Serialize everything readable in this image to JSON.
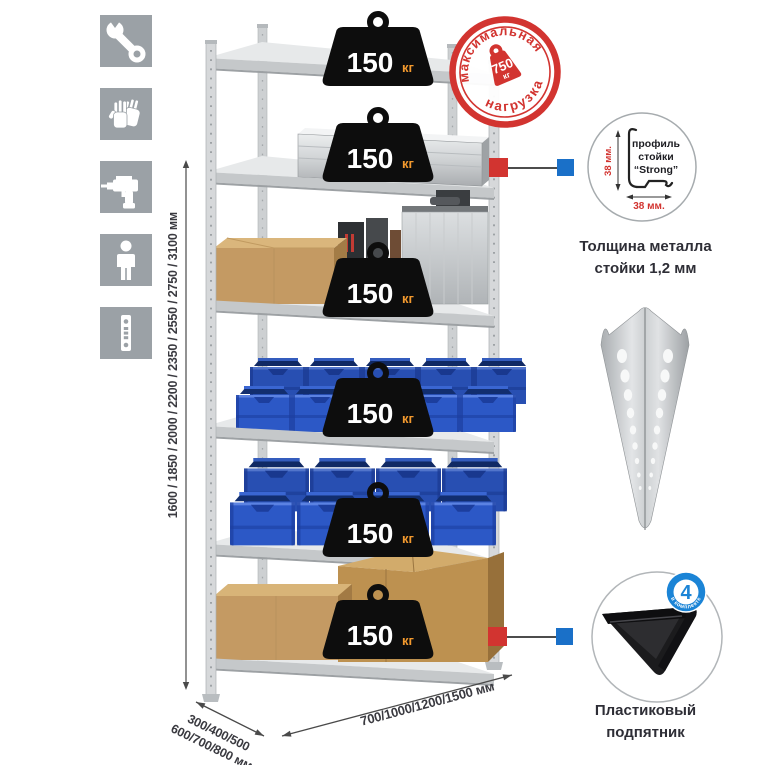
{
  "colors": {
    "accent-red": "#d23430",
    "accent-blue": "#1a70c8",
    "icon-gray": "#9ba1a6",
    "bin-blue": "#2c58c6",
    "unit-orange": "#f2992e",
    "text-dark": "#3a3a40",
    "cardboard": "#c49a63",
    "metal": "#d6d8da"
  },
  "left_icons": {
    "items": [
      {
        "name": "wrench"
      },
      {
        "name": "work-gloves"
      },
      {
        "name": "drill"
      },
      {
        "name": "person"
      },
      {
        "name": "perforated-post"
      }
    ]
  },
  "dimensions": {
    "height": "1600 / 1850 / 2000 / 2200 / 2350 / 2550 / 2750 / 3100 мм",
    "depth_line1": "300/400/500",
    "depth_line2": "600/700/800 мм",
    "width": "700/1000/1200/1500 мм"
  },
  "shelf": {
    "levels": [
      {
        "load": "150",
        "unit": "кг"
      },
      {
        "load": "150",
        "unit": "кг"
      },
      {
        "load": "150",
        "unit": "кг"
      },
      {
        "load": "150",
        "unit": "кг"
      },
      {
        "load": "150",
        "unit": "кг"
      },
      {
        "load": "150",
        "unit": "кг"
      }
    ]
  },
  "stamp": {
    "arc_top": "максимальная",
    "arc_bottom": "нагрузка",
    "value": "750",
    "unit": "кг"
  },
  "profile": {
    "label_line1": "профиль",
    "label_line2": "стойки",
    "label_line3": "“Strong”",
    "dim_vertical": "38 мм.",
    "dim_horizontal": "38 мм.",
    "caption_line1": "Толщина металла",
    "caption_line2": "стойки 1,2 мм"
  },
  "foot": {
    "badge_value": "4",
    "badge_arc": "в комплекте",
    "caption_line1": "Пластиковый",
    "caption_line2": "подпятник"
  }
}
